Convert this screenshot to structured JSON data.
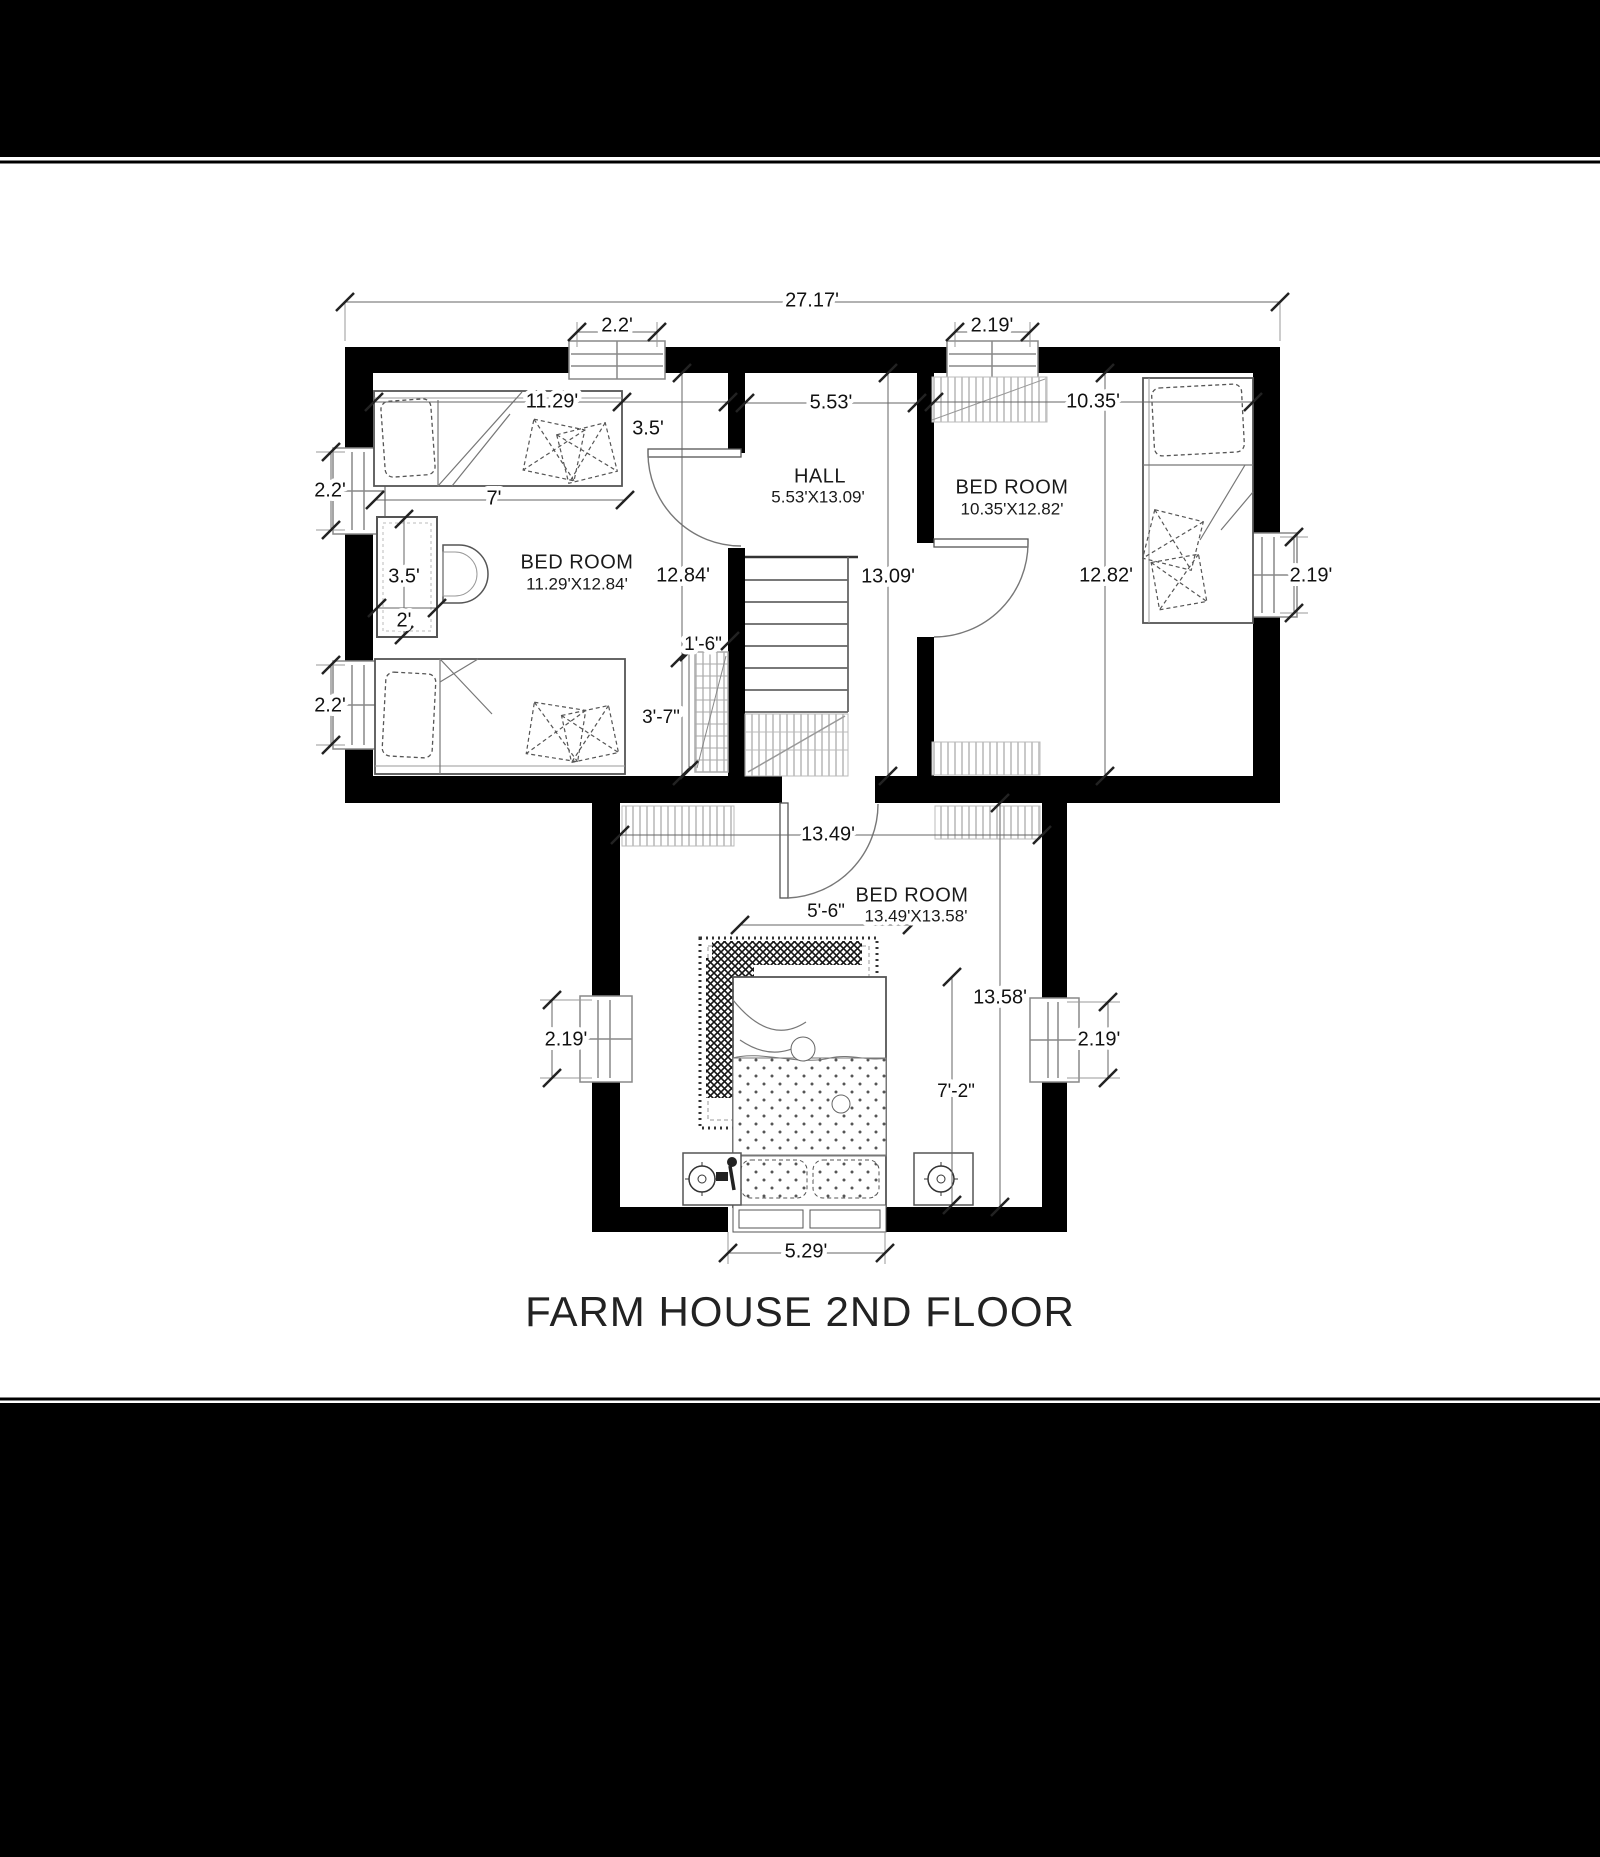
{
  "title": "FARM HOUSE 2ND FLOOR",
  "colors": {
    "wall": "#000000",
    "dimension_line": "#666666",
    "text": "#111111",
    "hatch": "#c9c9c9",
    "background": "#ffffff",
    "page_bar": "#000000"
  },
  "plan": {
    "rooms": [
      {
        "id": "hall",
        "label": "HALL",
        "size": "5.53'X13.09'"
      },
      {
        "id": "bedroom-left",
        "label": "BED ROOM",
        "size": "11.29'X12.84'"
      },
      {
        "id": "bedroom-right",
        "label": "BED ROOM",
        "size": "10.35'X12.82'"
      },
      {
        "id": "bedroom-bottom",
        "label": "BED ROOM",
        "size": "13.49'X13.58'"
      }
    ],
    "dimensions": {
      "overall_width": "27.17'",
      "top_window_left": "2.2'",
      "top_window_right": "2.19'",
      "bedroom_left_width": "11.29'",
      "door_offset": "3.5'",
      "hall_width": "5.53'",
      "bedroom_right_width": "10.35'",
      "side_window_upper": "2.2'",
      "side_window_lower": "2.2'",
      "bed_length": "7'",
      "wardrobe_depth": "3.5'",
      "wardrobe_width": "2'",
      "bedroom_left_height": "12.84'",
      "hall_height": "13.09'",
      "bedroom_right_height": "12.82'",
      "right_window": "2.19'",
      "stair_width": "1'-6\"",
      "stair_run": "3'-7\"",
      "bedroom_bottom_width": "13.49'",
      "rug_width": "5'-6\"",
      "bedroom_bottom_height": "13.58'",
      "bed_width": "7'-2\"",
      "bottom_window_left": "2.19'",
      "bottom_window_right": "2.19'",
      "headboard_width": "5.29'"
    }
  }
}
